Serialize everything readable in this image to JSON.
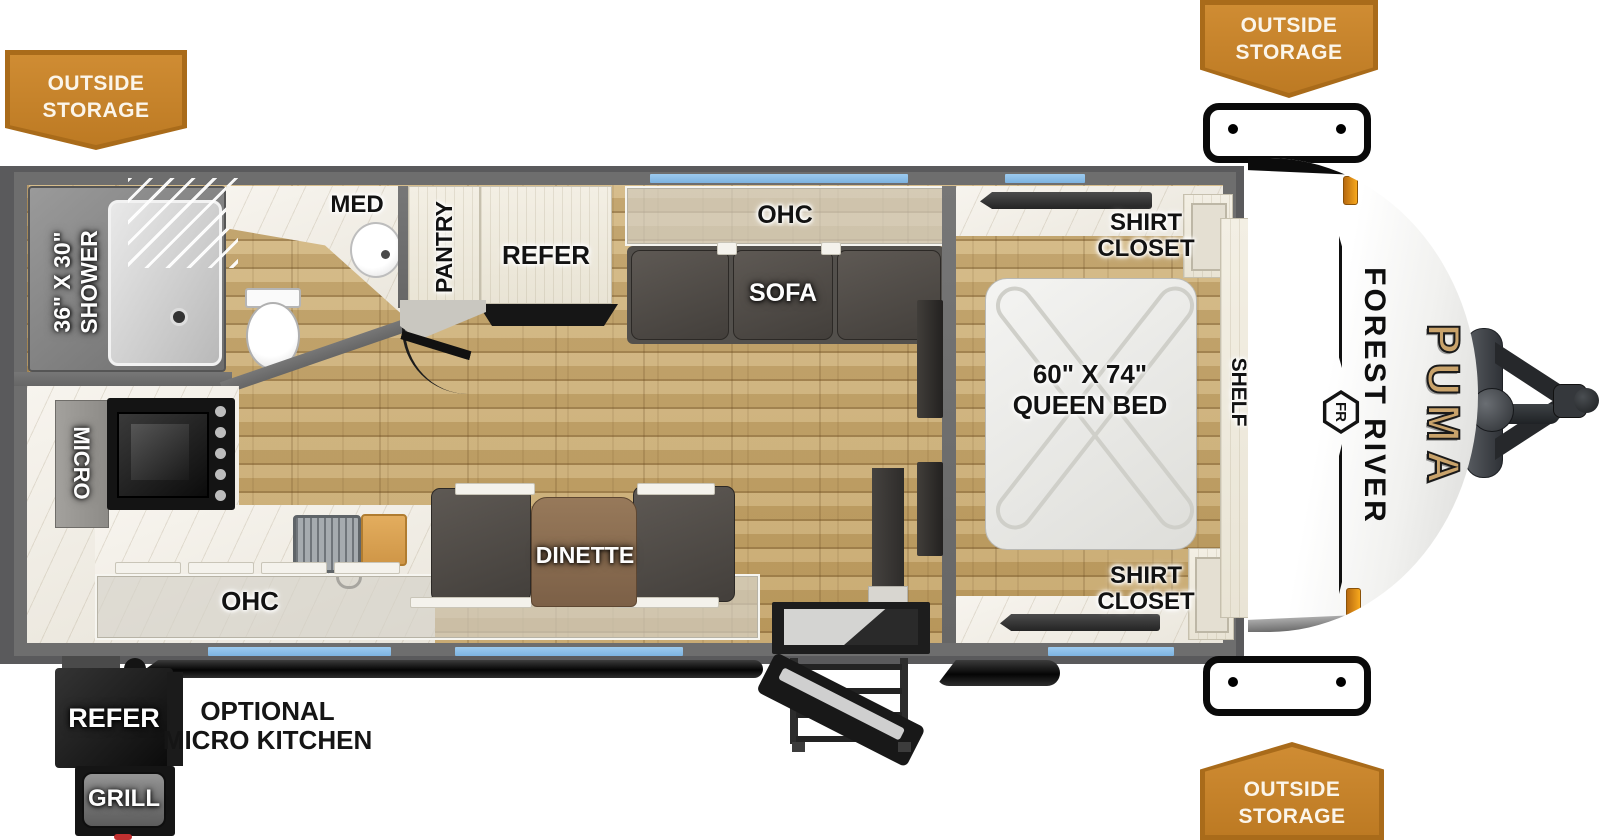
{
  "banners": {
    "top_left": {
      "line1": "OUTSIDE",
      "line2": "STORAGE"
    },
    "top_right": {
      "line1": "OUTSIDE",
      "line2": "STORAGE"
    },
    "bottom_right": {
      "line1": "OUTSIDE",
      "line2": "STORAGE"
    }
  },
  "bathroom": {
    "shower_size": "36\" X 30\"",
    "shower": "SHOWER",
    "med": "MED"
  },
  "kitchen": {
    "pantry": "PANTRY",
    "refer": "REFER",
    "micro": "MICRO",
    "ohc": "OHC",
    "dinette": "DINETTE"
  },
  "living": {
    "ohc": "OHC",
    "sofa": "SOFA"
  },
  "bedroom": {
    "closet_top_line1": "SHIRT",
    "closet_top_line2": "CLOSET",
    "closet_bottom_line1": "SHIRT",
    "closet_bottom_line2": "CLOSET",
    "bed_size": "60\" X 74\"",
    "bed": "QUEEN BED",
    "shelf": "SHELF"
  },
  "exterior": {
    "refer": "REFER",
    "grill": "GRILL",
    "optional_line1": "OPTIONAL",
    "optional_line2": "MICRO KITCHEN"
  },
  "branding": {
    "maker": "FOREST RIVER",
    "model": "PUMA",
    "logo": "FR"
  },
  "colors": {
    "banner_orange": "#bd7a23",
    "banner_border": "#a96b1a",
    "wall_gray": "#6e6e6e",
    "floor_wood": "#c9ab70",
    "window_blue": "#7db3e0",
    "puma_gold": "#c9a36b"
  }
}
